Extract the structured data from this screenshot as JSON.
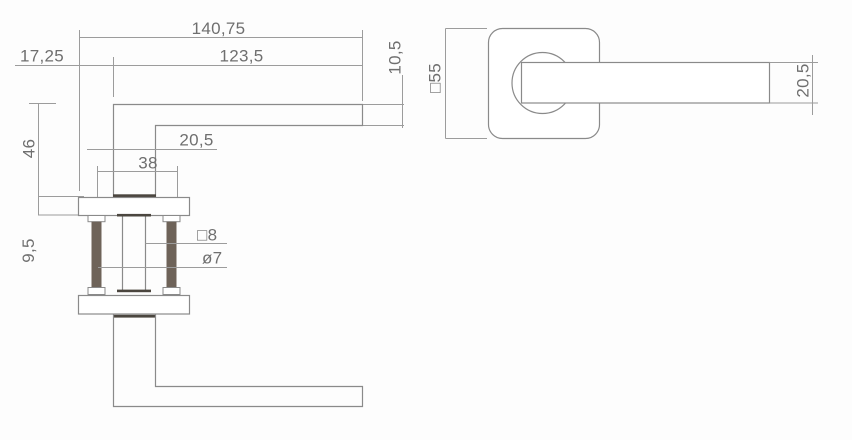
{
  "drawing": {
    "subject": "door lever handle on square rose - dimensioned technical drawing",
    "views": [
      "side-view",
      "front-view"
    ],
    "line_color": "#8a8a8a",
    "dim_line_color": "#9c9c9c",
    "text_color": "#6f6f6f",
    "screw_color": "#6e6359",
    "accent_dark": "#4b463f"
  },
  "dims": {
    "total_length": "140,75",
    "lever_length": "123,5",
    "offset": "17,25",
    "bar_thickness": "10,5",
    "height_to_rose": "46",
    "rose_thickness": "9,5",
    "neck_width": "20,5",
    "screw_spacing": "38",
    "spindle_square": "□8",
    "screw_diameter": "ø7",
    "rose_size": "□55",
    "lever_width": "20,5"
  }
}
